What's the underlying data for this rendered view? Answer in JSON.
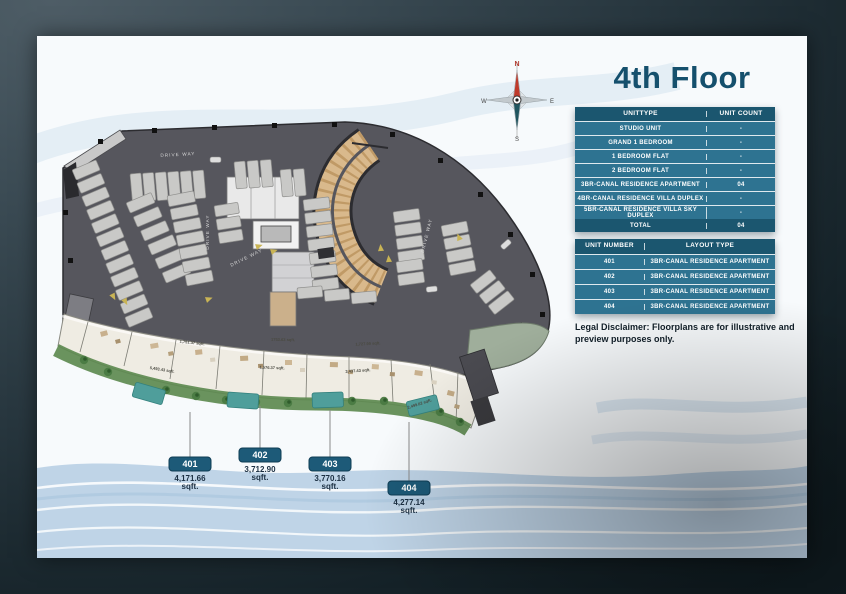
{
  "page_title": "4th Floor",
  "compass": {
    "north": "N",
    "east": "E",
    "south": "S",
    "west": "W"
  },
  "unit_type_table": {
    "col1_header": "UNITTYPE",
    "col2_header": "UNIT COUNT",
    "rows": [
      {
        "type": "STUDIO UNIT",
        "count": "-"
      },
      {
        "type": "GRAND 1 BEDROOM",
        "count": "-"
      },
      {
        "type": "1 BEDROOM FLAT",
        "count": "-"
      },
      {
        "type": "2 BEDROOM FLAT",
        "count": "-"
      },
      {
        "type": "3BR-CANAL RESIDENCE APARTMENT",
        "count": "04"
      },
      {
        "type": "4BR-CANAL RESIDENCE VILLA DUPLEX",
        "count": "-"
      },
      {
        "type": "5BR-CANAL RESIDENCE VILLA SKY DUPLEX",
        "count": "-"
      }
    ],
    "total_label": "TOTAL",
    "total_value": "04"
  },
  "unit_number_table": {
    "col1_header": "UNIT NUMBER",
    "col2_header": "LAYOUT TYPE",
    "rows": [
      {
        "number": "401",
        "layout": "3BR-CANAL RESIDENCE APARTMENT"
      },
      {
        "number": "402",
        "layout": "3BR-CANAL RESIDENCE APARTMENT"
      },
      {
        "number": "403",
        "layout": "3BR-CANAL RESIDENCE APARTMENT"
      },
      {
        "number": "404",
        "layout": "3BR-CANAL RESIDENCE APARTMENT"
      }
    ]
  },
  "disclaimer": "Legal Disclaimer: Floorplans are for illustrative and preview purposes only.",
  "unit_labels": [
    {
      "number": "401",
      "area": "4,171.66",
      "unit": "sqft."
    },
    {
      "number": "402",
      "area": "3,712.90",
      "unit": "sqft."
    },
    {
      "number": "403",
      "area": "3,770.16",
      "unit": "sqft."
    },
    {
      "number": "404",
      "area": "4,277.14",
      "unit": "sqft."
    }
  ],
  "plan": {
    "driveway_label": "DRIVE WAY",
    "annotations": [
      "1,751.37 sqft.",
      "1753.63 sqft.",
      "1,727.99 sqft.",
      "5,493.43 sqft.",
      "1,576.37 sqft.",
      "3,437.43 sqft.",
      "2,499.62 sqft."
    ]
  },
  "colors": {
    "table_header": "#1b566f",
    "table_row": "#2e7391",
    "pill": "#1d5a78",
    "title": "#15506d",
    "deck": "#56565d",
    "ramp": "#d9b98c",
    "pool": "#4f9e9b",
    "greenery": "#5d8a50"
  }
}
